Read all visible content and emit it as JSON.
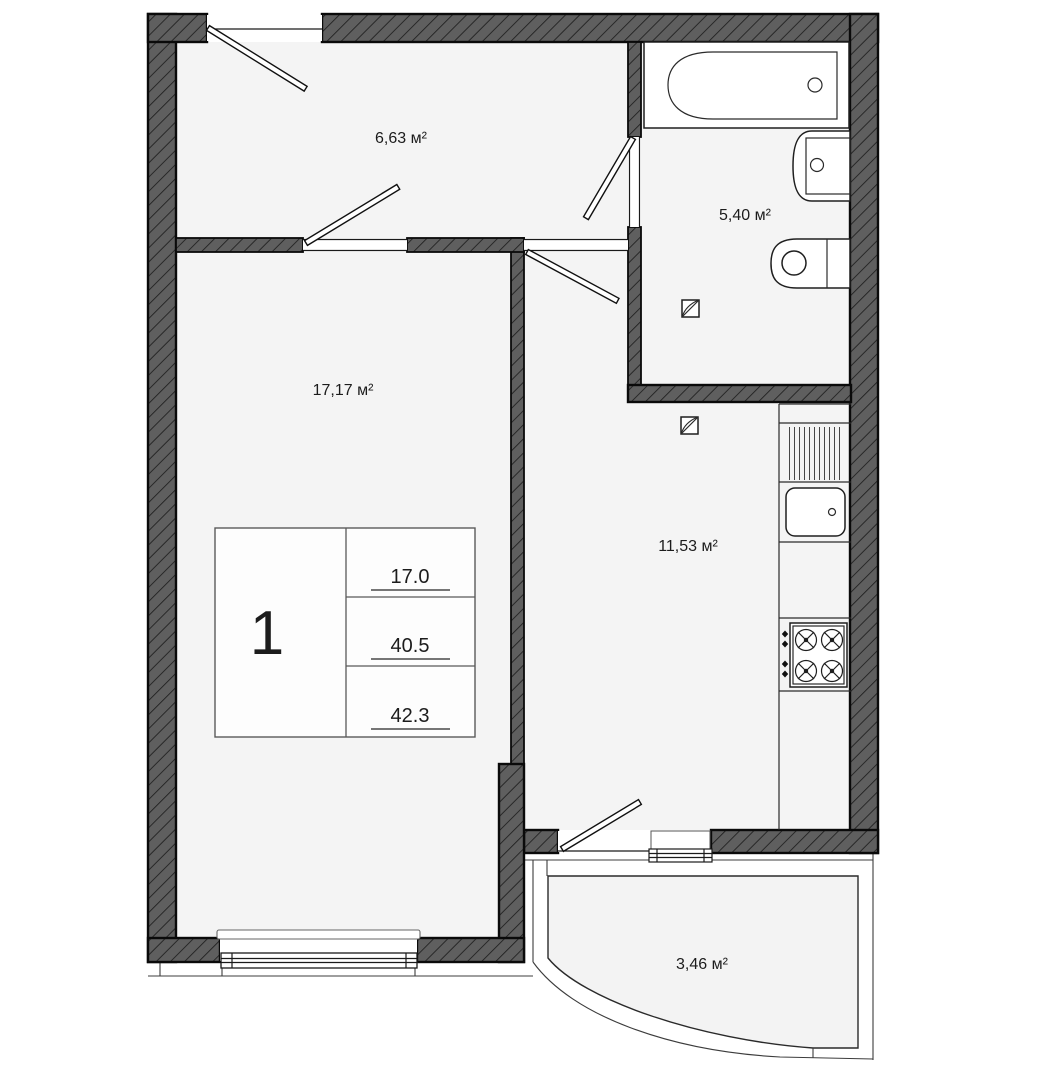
{
  "plan": {
    "rooms": {
      "hallway": {
        "area_label": "6,63 м²"
      },
      "bathroom": {
        "area_label": "5,40 м²"
      },
      "living_room": {
        "area_label": "17,17 м²"
      },
      "kitchen": {
        "area_label": "11,53 м²"
      },
      "balcony": {
        "area_label": "3,46 м²"
      }
    },
    "stamp": {
      "apartment_number": "1",
      "values": [
        "17.0",
        "40.5",
        "42.3"
      ]
    },
    "colors": {
      "wall_fill": "#5f5f5f",
      "hatch_line": "#1e1e1e",
      "floor": "#f4f4f4",
      "outline": "#0a0a0a",
      "background": "#ffffff",
      "stamp_line": "#5a5a5a"
    }
  }
}
